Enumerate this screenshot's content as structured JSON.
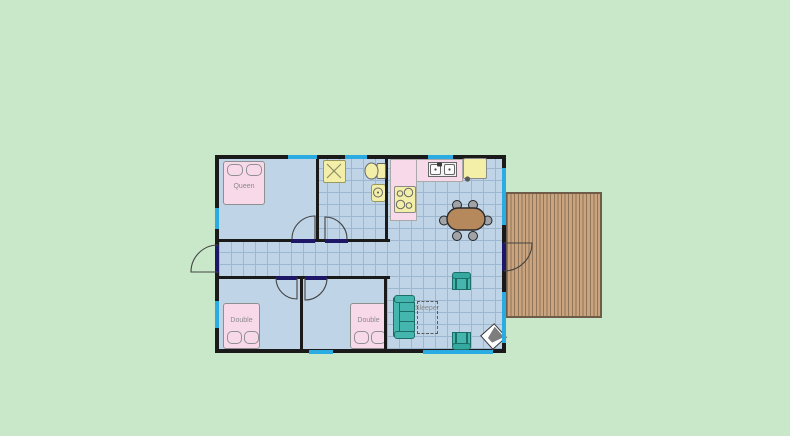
{
  "plan": {
    "labels": {
      "queen_bed": "Queen",
      "double_bed_left": "Double",
      "double_bed_right": "Double",
      "sleeper_sofa": "Sleeper"
    },
    "colors": {
      "background": "#c9e7c9",
      "floor_blue": "#bfd4e7",
      "grid_line": "#9db7d1",
      "wall_black": "#1a1a1a",
      "window_cyan": "#2aace2",
      "door_threshold_navy": "#1e1666",
      "bed_pink": "#f8d9e9",
      "fixture_yellow": "#f3eea8",
      "sofa_teal": "#44b6ae",
      "table_brown": "#b5895c",
      "deck_tan": "#c9a47e"
    }
  }
}
